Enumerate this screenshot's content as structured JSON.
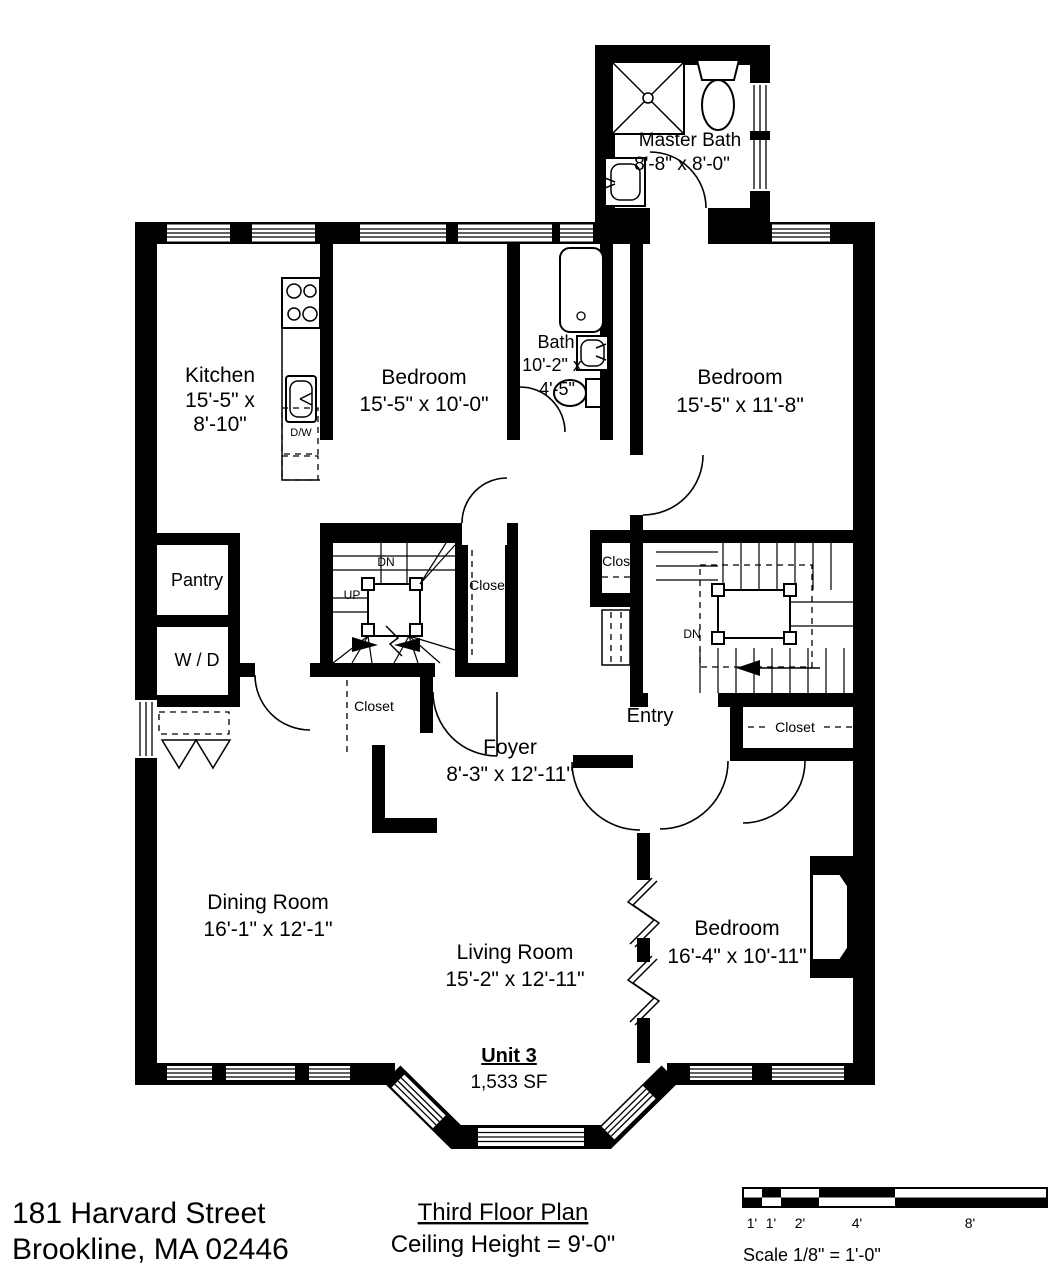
{
  "footer": {
    "address_line1": "181 Harvard Street",
    "address_line2": "Brookline, MA 02446",
    "plan_title": "Third Floor Plan",
    "ceiling_height": "Ceiling Height = 9'-0\""
  },
  "scale_bar": {
    "label": "Scale  1/8\" = 1'-0\"",
    "ticks": [
      "1'",
      "1'",
      "2'",
      "4'",
      "8'"
    ]
  },
  "unit": {
    "name": "Unit 3",
    "area": "1,533 SF"
  },
  "rooms": {
    "master_bath": {
      "name": "Master Bath",
      "dims": "8'-8\" x 8'-0\""
    },
    "kitchen": {
      "name": "Kitchen",
      "dims_line1": "15'-5\" x",
      "dims_line2": "8'-10\""
    },
    "bedroom_top": {
      "name": "Bedroom",
      "dims": "15'-5\" x 10'-0\""
    },
    "bath": {
      "name": "Bath",
      "dims_line1": "10'-2\" x",
      "dims_line2": "4'-5\""
    },
    "bedroom_right_top": {
      "name": "Bedroom",
      "dims": "15'-5\" x 11'-8\""
    },
    "pantry": {
      "name": "Pantry"
    },
    "laundry": {
      "name": "W / D"
    },
    "foyer": {
      "name": "Foyer",
      "dims": "8'-3\" x 12'-11\""
    },
    "entry": {
      "name": "Entry"
    },
    "dining_room": {
      "name": "Dining Room",
      "dims": "16'-1\" x 12'-1\""
    },
    "living_room": {
      "name": "Living Room",
      "dims": "15'-2\" x 12'-11\""
    },
    "bedroom_right_bottom": {
      "name": "Bedroom",
      "dims": "16'-4\" x 10'-11\""
    }
  },
  "annotations": {
    "closet": "Closet",
    "down": "DN",
    "up": "UP",
    "dishwasher": "D/W"
  },
  "colors": {
    "ink": "#000000",
    "background": "#ffffff"
  }
}
